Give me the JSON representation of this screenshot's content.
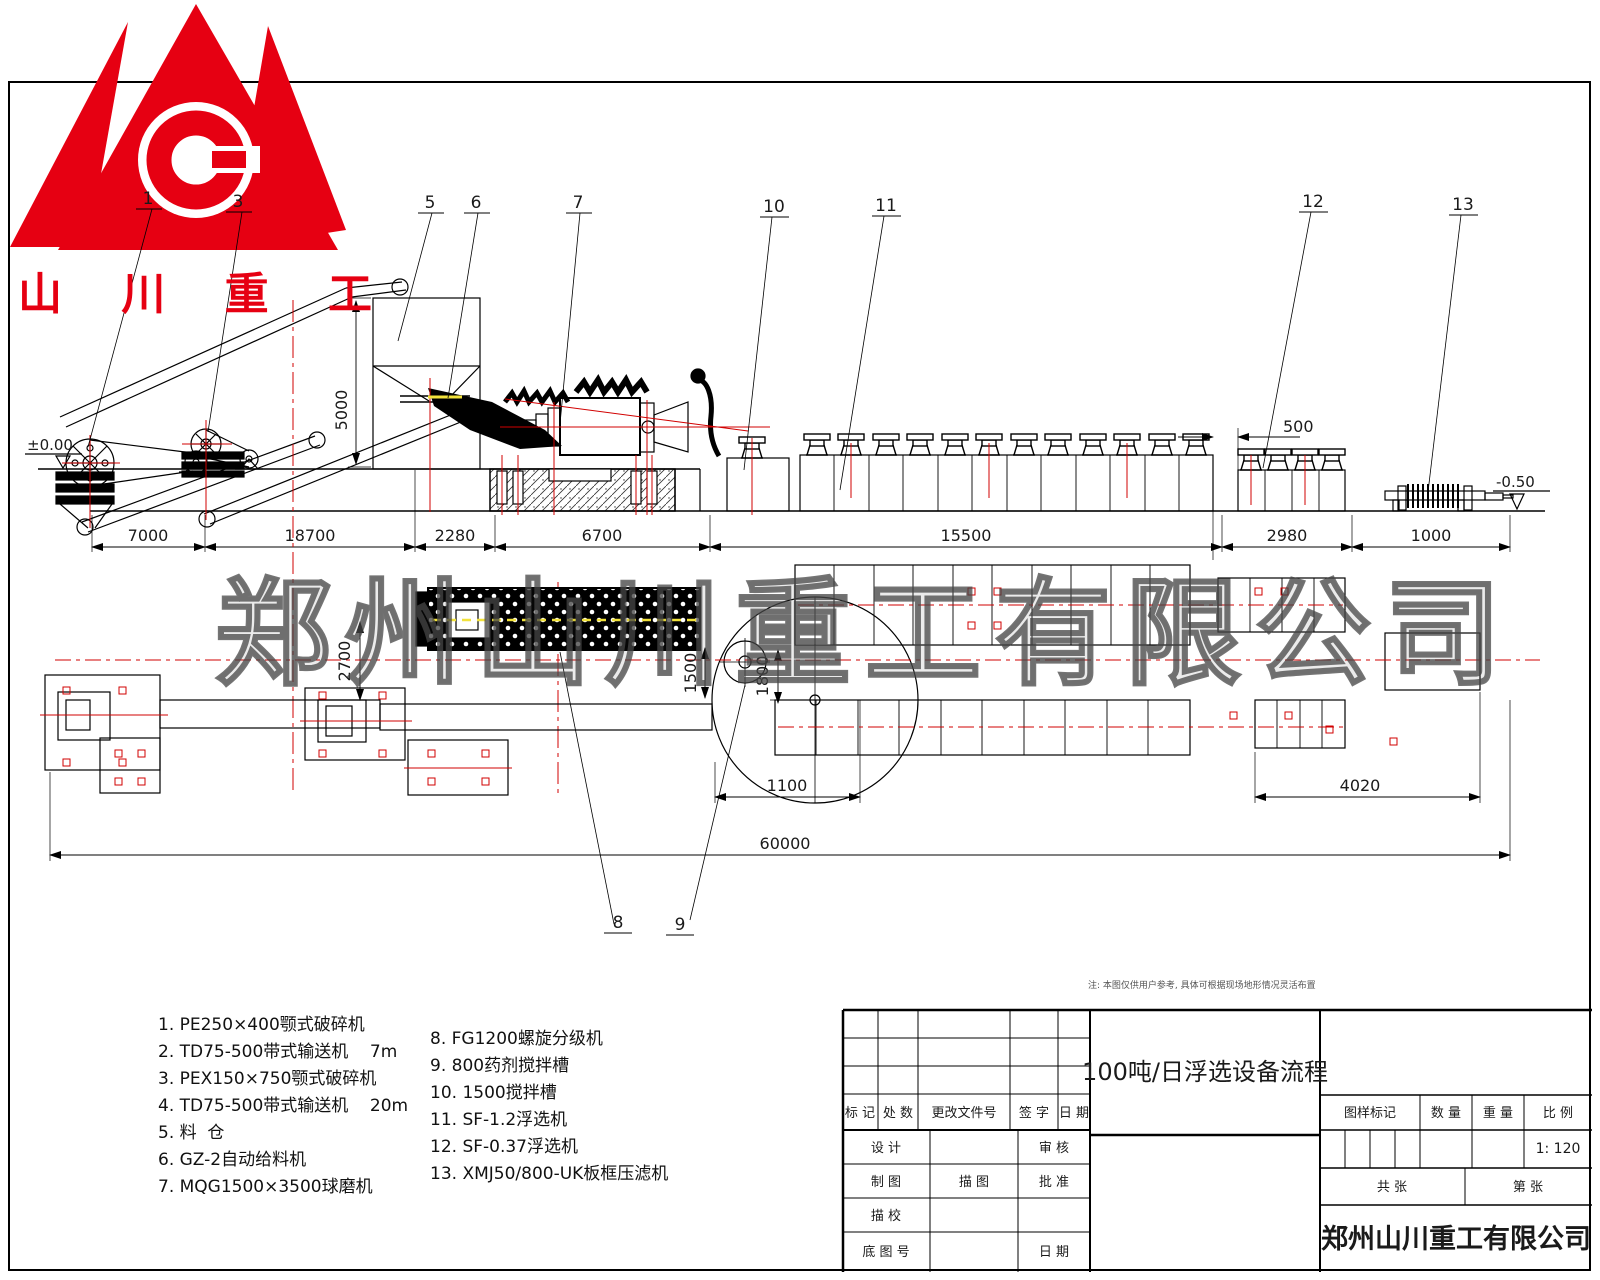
{
  "logo": {
    "company_short": "山 川 重 工",
    "letter": "C",
    "brand_color": "#e60012"
  },
  "watermark": {
    "text": "郑州山川重工有限公司"
  },
  "note": "注: 本图仅供用户参考, 具体可根据现场地形情况灵活布置",
  "callouts": {
    "c1": "1",
    "c3": "3",
    "c5": "5",
    "c6": "6",
    "c7": "7",
    "c8": "8",
    "c9": "9",
    "c10": "10",
    "c11": "11",
    "c12": "12",
    "c13": "13"
  },
  "dims": {
    "e1": "7000",
    "e2": "18700",
    "e3": "2280",
    "e4": "6700",
    "e5": "15500",
    "e6": "2980",
    "e7": "1000",
    "silo": "5000",
    "gap": "500",
    "lvl_left": "±0.00",
    "lvl_right": "-0.50",
    "p2700": "2700",
    "p1500": "1500",
    "p1800": "1800",
    "p1100": "1100",
    "p4020": "4020",
    "total": "60000"
  },
  "legend": {
    "left": [
      "1. PE250×400颚式破碎机",
      "2. TD75-500带式输送机    7m",
      "3. PEX150×750颚式破碎机",
      "4. TD75-500带式输送机    20m",
      "5. 料  仓",
      "6. GZ-2自动给料机",
      "7. MQG1500×3500球磨机"
    ],
    "right": [
      "8. FG1200螺旋分级机",
      "9. 800药剂搅拌槽",
      "10. 1500搅拌槽",
      "11. SF-1.2浮选机",
      "12. SF-0.37浮选机",
      "13. XMJ50/800-UK板框压滤机"
    ]
  },
  "title_block": {
    "drawing_title": "100吨/日浮选设备流程",
    "company": "郑州山川重工有限公司",
    "scale_value": "1: 120",
    "rev_header": [
      "标 记",
      "处 数",
      "更改文件号",
      "签 字",
      "日 期"
    ],
    "row1": [
      "设 计",
      "审 核"
    ],
    "row2": [
      "制 图",
      "描 图",
      "批 准"
    ],
    "row3": [
      "描 校"
    ],
    "row4": [
      "底 图 号",
      "日 期"
    ],
    "right_header": [
      "图样标记",
      "数 量",
      "重 量",
      "比 例"
    ],
    "sheet": [
      "共  张",
      "第  张"
    ]
  }
}
